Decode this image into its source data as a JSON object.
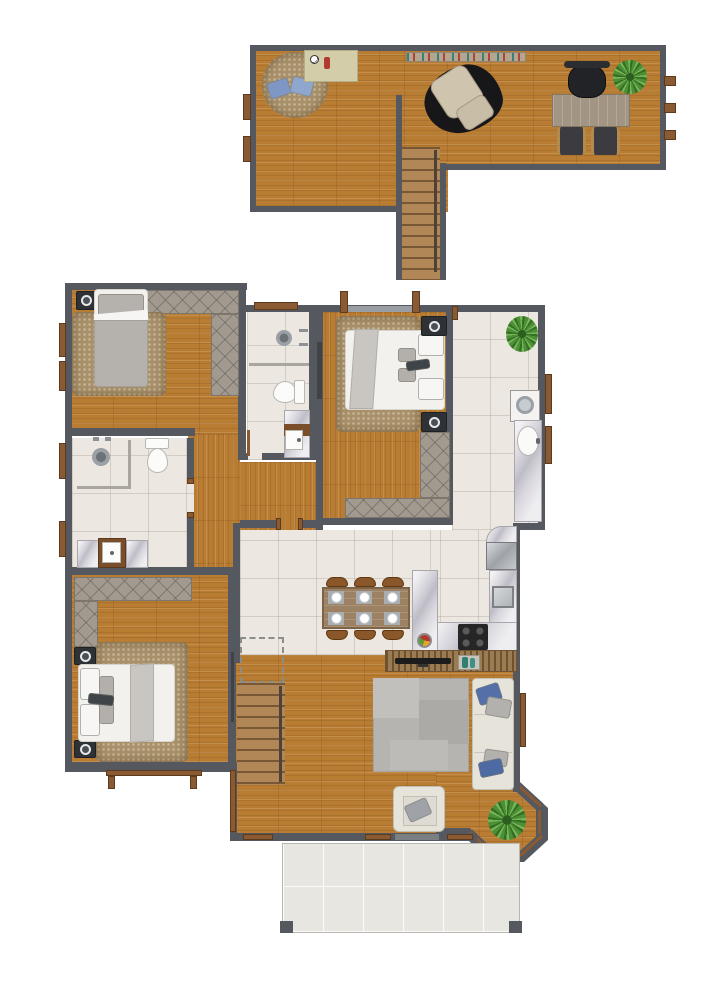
{
  "meta": {
    "kind": "architectural floor plan, top-down 2D color render, no text labels",
    "canvas": {
      "width": 720,
      "height": 1000
    },
    "background": "#ffffff"
  },
  "palette": {
    "wall": "#55595f",
    "wood": "#b87c33",
    "woodStair": "#b28758",
    "tile": "#ece8e1",
    "porch": "#e8e6e1",
    "hatch": "#a29a8e",
    "frame": "#8a5a33",
    "marble": "#d9d7dd",
    "rugTan": "#a8906a",
    "rugGray": "#b5b4b0",
    "bedWhite": "#f2f1ee",
    "textileGray": "#b5b2ae",
    "sofaCream": "#e6e4da",
    "pillowBlue": "#5570a8",
    "plantGreen": "#4c8f35",
    "steel": "#b9bcc0",
    "stove": "#262626",
    "tableWood": "#9c8263",
    "chairBrown": "#8a572b",
    "glaz": "#989ea4",
    "dark": "#2e3237"
  },
  "upper_floor": {
    "rooms": [
      {
        "name": "loft-lounge",
        "floor": "wood",
        "furniture": [
          "round-rug",
          "blue-cushion",
          "blue-cushion",
          "play-mat-with-soccer-ball",
          "wall-shelf-decor"
        ]
      },
      {
        "name": "study",
        "floor": "wood",
        "furniture": [
          "recliner",
          "animal-hide-rug",
          "desk",
          "office-chair",
          "guest-chair",
          "guest-chair",
          "potted-plant"
        ],
        "windows": 3
      }
    ],
    "stairs": {
      "type": "straight-run",
      "connects": "loft to main floor"
    }
  },
  "main_floor": {
    "rooms": [
      {
        "name": "bedroom-1",
        "floor": "wood",
        "furniture": [
          "single-bed",
          "shag-rug",
          "nightstand-speaker",
          "l-shaped-closet"
        ],
        "windows": 2
      },
      {
        "name": "bathroom-1",
        "floor": "tile",
        "furniture": [
          "shower",
          "towel-bars",
          "toilet",
          "marble-vanity-sink",
          "door"
        ],
        "windows": 1
      },
      {
        "name": "bedroom-2",
        "floor": "wood",
        "furniture": [
          "double-bed",
          "shag-rug",
          "nightstand-speaker",
          "nightstand-speaker",
          "l-shaped-closet"
        ],
        "windows": 1
      },
      {
        "name": "kitchen",
        "floor": "tile",
        "furniture": [
          "potted-plant",
          "washing-machine",
          "marble-counter-oval-sink",
          "fridge",
          "marble-counter-square-sink",
          "cooktop-4-burner",
          "marble-peninsula",
          "fruit-bowl"
        ],
        "windows": 2
      },
      {
        "name": "bathroom-2",
        "floor": "tile",
        "furniture": [
          "shower",
          "glass-screen",
          "toilet",
          "marble-vanity-sink"
        ],
        "windows": 2
      },
      {
        "name": "bedroom-3",
        "floor": "wood",
        "furniture": [
          "double-bed",
          "shag-rug",
          "nightstand-speaker",
          "nightstand-speaker",
          "l-shaped-closet",
          "door"
        ],
        "exterior": "deck-frame"
      },
      {
        "name": "dining-area",
        "floor": "tile",
        "furniture": [
          "dining-table",
          "chair",
          "chair",
          "chair",
          "chair",
          "chair",
          "chair",
          "place-settings-x6"
        ]
      },
      {
        "name": "living-room",
        "floor": "wood",
        "furniture": [
          "tv-slat-console",
          "tv",
          "decor-tray",
          "patch-rug",
          "sofa-with-pillows",
          "armchair",
          "potted-plant",
          "staircase",
          "bay-window"
        ],
        "windows": 4
      },
      {
        "name": "porch",
        "floor": "tile",
        "furniture": [
          "corner-post",
          "corner-post"
        ]
      }
    ]
  }
}
